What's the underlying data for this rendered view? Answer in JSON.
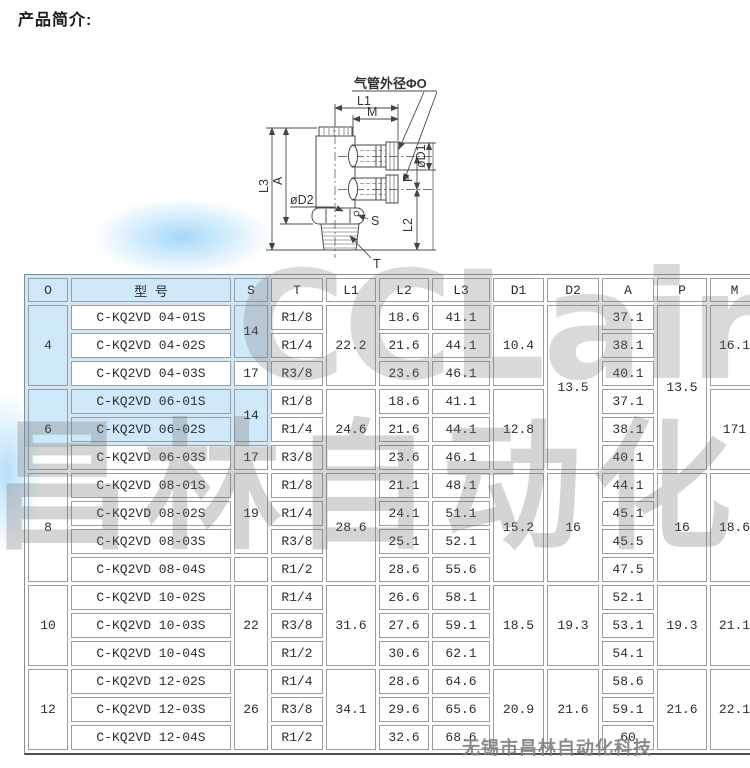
{
  "page": {
    "title": "产品简介:"
  },
  "diagram": {
    "labels": {
      "tube_od": "气管外径ΦO",
      "l1": "L1",
      "m": "M",
      "l3": "L3",
      "a": "A",
      "d2": "øD2",
      "s": "S",
      "t": "T",
      "l2": "L2",
      "d1": "øD1",
      "p": "P"
    }
  },
  "watermarks": {
    "brand": "CCLair",
    "cn": "昌林自动化",
    "footer": "无锡市昌林自动化科技"
  },
  "table": {
    "col_widths": [
      40,
      160,
      34,
      52,
      50,
      50,
      58,
      51,
      52,
      52,
      50,
      49
    ],
    "rows": [
      [
        {
          "t": "O",
          "cls": "blue"
        },
        {
          "t": "型  号",
          "cls": "blue"
        },
        {
          "t": "S",
          "cls": "blue"
        },
        {
          "t": "T"
        },
        {
          "t": "L1"
        },
        {
          "t": "L2"
        },
        {
          "t": "L3"
        },
        {
          "t": "D1"
        },
        {
          "t": "D2"
        },
        {
          "t": "A"
        },
        {
          "t": "P"
        },
        {
          "t": "M"
        }
      ],
      [
        {
          "t": "4",
          "rs": 3,
          "cls": "blue"
        },
        {
          "t": "C-KQ2VD 04-01S"
        },
        {
          "t": "14",
          "rs": 2,
          "cls": "blue"
        },
        {
          "t": "R1/8"
        },
        {
          "t": "22.2",
          "rs": 3
        },
        {
          "t": "18.6"
        },
        {
          "t": "41.1"
        },
        {
          "t": "10.4",
          "rs": 3
        },
        {
          "t": "13.5",
          "rs": 6
        },
        {
          "t": "37.1"
        },
        {
          "t": "13.5",
          "rs": 6
        },
        {
          "t": "16.1",
          "rs": 3
        }
      ],
      [
        {
          "t": "C-KQ2VD 04-02S"
        },
        {
          "t": "R1/4"
        },
        {
          "t": "21.6"
        },
        {
          "t": "44.1"
        },
        {
          "t": "38.1"
        }
      ],
      [
        {
          "t": "C-KQ2VD 04-03S"
        },
        {
          "t": "17"
        },
        {
          "t": "R3/8"
        },
        {
          "t": "23.6"
        },
        {
          "t": "46.1"
        },
        {
          "t": "40.1"
        }
      ],
      [
        {
          "t": "6",
          "rs": 3,
          "cls": "blue"
        },
        {
          "t": "C-KQ2VD 06-01S",
          "cls": "blue"
        },
        {
          "t": "14",
          "rs": 2,
          "cls": "blue"
        },
        {
          "t": "R1/8"
        },
        {
          "t": "24.6",
          "rs": 3
        },
        {
          "t": "18.6"
        },
        {
          "t": "41.1"
        },
        {
          "t": "12.8",
          "rs": 3
        },
        {
          "t": "37.1"
        },
        {
          "t": "171",
          "rs": 3
        }
      ],
      [
        {
          "t": "C-KQ2VD 06-02S",
          "cls": "blue"
        },
        {
          "t": "R1/4"
        },
        {
          "t": "21.6"
        },
        {
          "t": "44.1"
        },
        {
          "t": "38.1"
        }
      ],
      [
        {
          "t": "C-KQ2VD 06-03S"
        },
        {
          "t": "17"
        },
        {
          "t": "R3/8"
        },
        {
          "t": "23.6"
        },
        {
          "t": "46.1"
        },
        {
          "t": "40.1"
        }
      ],
      [
        {
          "t": "8",
          "rs": 4
        },
        {
          "t": "C-KQ2VD 08-01S"
        },
        {
          "t": "19",
          "rs": 3
        },
        {
          "t": "R1/8"
        },
        {
          "t": "28.6",
          "rs": 4
        },
        {
          "t": "21.1"
        },
        {
          "t": "48.1"
        },
        {
          "t": "15.2",
          "rs": 4
        },
        {
          "t": "16",
          "rs": 4
        },
        {
          "t": "44.1"
        },
        {
          "t": "16",
          "rs": 4
        },
        {
          "t": "18.6",
          "rs": 4
        }
      ],
      [
        {
          "t": "C-KQ2VD 08-02S"
        },
        {
          "t": "R1/4"
        },
        {
          "t": "24.1"
        },
        {
          "t": "51.1"
        },
        {
          "t": "45.1"
        }
      ],
      [
        {
          "t": "C-KQ2VD 08-03S"
        },
        {
          "t": "R3/8"
        },
        {
          "t": "25.1"
        },
        {
          "t": "52.1"
        },
        {
          "t": "45.5"
        }
      ],
      [
        {
          "t": "C-KQ2VD 08-04S"
        },
        {
          "t": ""
        },
        {
          "t": "R1/2"
        },
        {
          "t": "28.6"
        },
        {
          "t": "55.6"
        },
        {
          "t": "47.5"
        }
      ],
      [
        {
          "t": "10",
          "rs": 3
        },
        {
          "t": "C-KQ2VD 10-02S"
        },
        {
          "t": "22",
          "rs": 3
        },
        {
          "t": "R1/4"
        },
        {
          "t": "31.6",
          "rs": 3
        },
        {
          "t": "26.6"
        },
        {
          "t": "58.1"
        },
        {
          "t": "18.5",
          "rs": 3
        },
        {
          "t": "19.3",
          "rs": 3
        },
        {
          "t": "52.1"
        },
        {
          "t": "19.3",
          "rs": 3
        },
        {
          "t": "21.1",
          "rs": 3
        }
      ],
      [
        {
          "t": "C-KQ2VD 10-03S"
        },
        {
          "t": "R3/8"
        },
        {
          "t": "27.6"
        },
        {
          "t": "59.1"
        },
        {
          "t": "53.1"
        }
      ],
      [
        {
          "t": "C-KQ2VD 10-04S"
        },
        {
          "t": "R1/2"
        },
        {
          "t": "30.6"
        },
        {
          "t": "62.1"
        },
        {
          "t": "54.1"
        }
      ],
      [
        {
          "t": "12",
          "rs": 3
        },
        {
          "t": "C-KQ2VD 12-02S"
        },
        {
          "t": "26",
          "rs": 3
        },
        {
          "t": "R1/4"
        },
        {
          "t": "34.1",
          "rs": 3
        },
        {
          "t": "28.6"
        },
        {
          "t": "64.6"
        },
        {
          "t": "20.9",
          "rs": 3
        },
        {
          "t": "21.6",
          "rs": 3
        },
        {
          "t": "58.6"
        },
        {
          "t": "21.6",
          "rs": 3
        },
        {
          "t": "22.1",
          "rs": 3
        }
      ],
      [
        {
          "t": "C-KQ2VD 12-03S"
        },
        {
          "t": "R3/8"
        },
        {
          "t": "29.6"
        },
        {
          "t": "65.6"
        },
        {
          "t": "59.1"
        }
      ],
      [
        {
          "t": "C-KQ2VD 12-04S"
        },
        {
          "t": "R1/2"
        },
        {
          "t": "32.6"
        },
        {
          "t": "68.6"
        },
        {
          "t": "60"
        }
      ]
    ]
  }
}
